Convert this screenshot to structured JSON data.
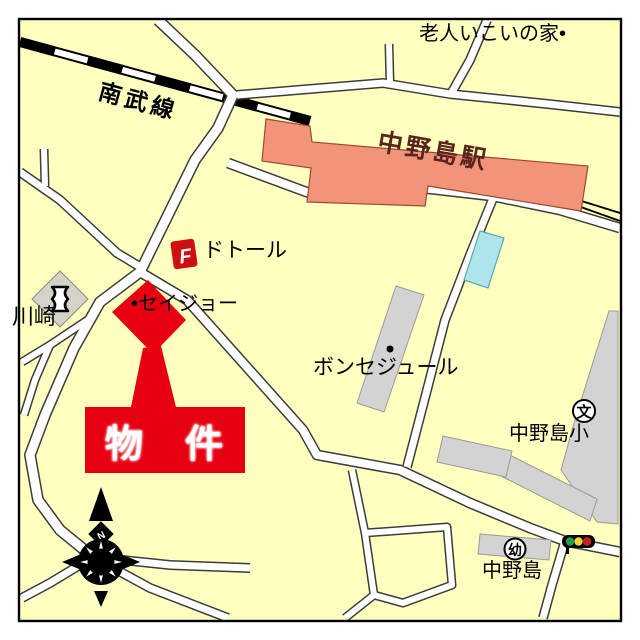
{
  "labels": {
    "railway": "南武線",
    "station": "中野島駅",
    "elder_house": "老人いこいの家•",
    "doutor": "ドトール",
    "seijo": "•セイジョー",
    "kawasaki": "川崎",
    "bon_sejour": "ボンセジュール",
    "elementary_school": "中野島小",
    "nakanoshima": "中野島",
    "property": "物　件"
  },
  "icons": {
    "doutor_logo": "F",
    "compass_north": "N",
    "school_symbol": "文",
    "kindergarten_symbol": "幼"
  },
  "colors": {
    "map_bg": "#FFFFC0",
    "road_fill": "#FFFFFF",
    "road_casing": "#3C3C3C",
    "railway": "#000000",
    "station_fill": "#F2947A",
    "station_border": "#9C4A32",
    "station_text": "#5A241C",
    "building_gray": "#D3D3D3",
    "building_border": "#9A9A92",
    "pool_fill": "#AEE4EC",
    "pool_border": "#5AA8B0",
    "accent_red": "#E60012",
    "traffic_green": "#1F9E4C",
    "traffic_yellow": "#F2D23C",
    "traffic_red": "#CC2020"
  }
}
